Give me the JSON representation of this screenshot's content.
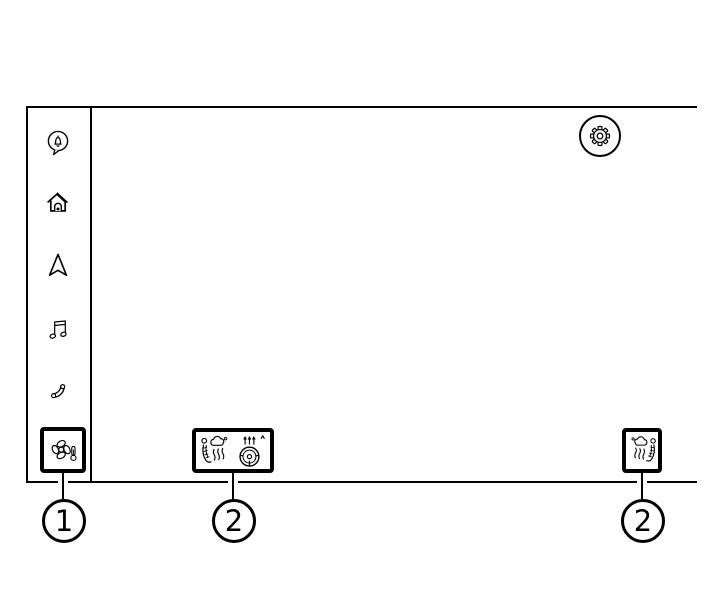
{
  "colors": {
    "ink": "#000000",
    "background": "#ffffff"
  },
  "screen": {
    "sidebar": {
      "items": [
        {
          "icon": "notification-bubble-icon"
        },
        {
          "icon": "home-icon"
        },
        {
          "icon": "navigation-arrow-icon"
        },
        {
          "icon": "music-note-icon"
        },
        {
          "icon": "phone-icon"
        },
        {
          "icon": "climate-fan-icon",
          "highlighted": true
        }
      ]
    },
    "header": {
      "icon": "gear-icon"
    },
    "climate_bar_center": {
      "icons": [
        "ventilated-seat-icon",
        "heated-steering-wheel-icon"
      ]
    },
    "climate_bar_right": {
      "icons": [
        "ventilated-seat-mirrored-icon"
      ]
    }
  },
  "callouts": [
    {
      "number": "1"
    },
    {
      "number": "2"
    },
    {
      "number": "2"
    }
  ]
}
